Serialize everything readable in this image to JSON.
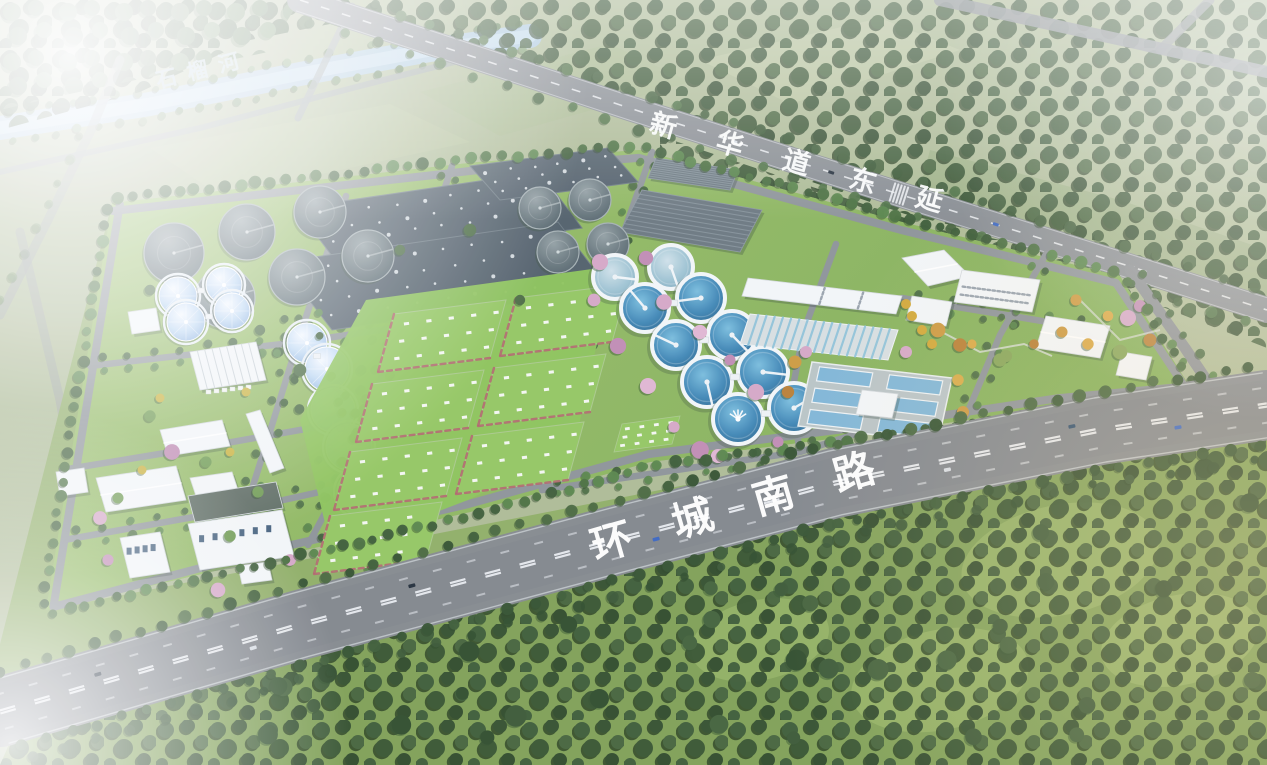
{
  "labels": {
    "river": {
      "text": "石榴河"
    },
    "road_top": {
      "text": "新华道东延"
    },
    "road_bottom": {
      "text": "环城南路"
    }
  },
  "palette": {
    "haze_white": "#ffffff",
    "field_green": "#a9b98c",
    "field_light": "#b7c49e",
    "forest_green": "#3a5835",
    "forest_deep": "#2f4c2c",
    "tree_green": "#49703f",
    "tree_light": "#6f9b52",
    "site_lawn": "#8fb761",
    "lawn_bright": "#93c761",
    "road_grey": "#84898e",
    "road_inner": "#8d9398",
    "marking_white": "#f2f5f7",
    "river_blue": "#aac8de",
    "water_blue": "#3d86b5",
    "water_light": "#7fc0e0",
    "dome_blue": "#a9cdf0",
    "tank_grey": "#5f6e76",
    "basin_grey": "#515f6a",
    "building_white": "#f3f6f8",
    "building_shade": "#c9ced3",
    "blossom_pink": "#d5a7c7",
    "blossom_deep": "#c08cb4",
    "autumn_amber": "#cd9a40",
    "autumn_deep": "#b97f35",
    "red_shrub": "#b2606b",
    "car_dark": "#222e3a",
    "car_blue": "#3a66c0",
    "car_white": "#d8dee4",
    "label_white": "#ffffff"
  }
}
